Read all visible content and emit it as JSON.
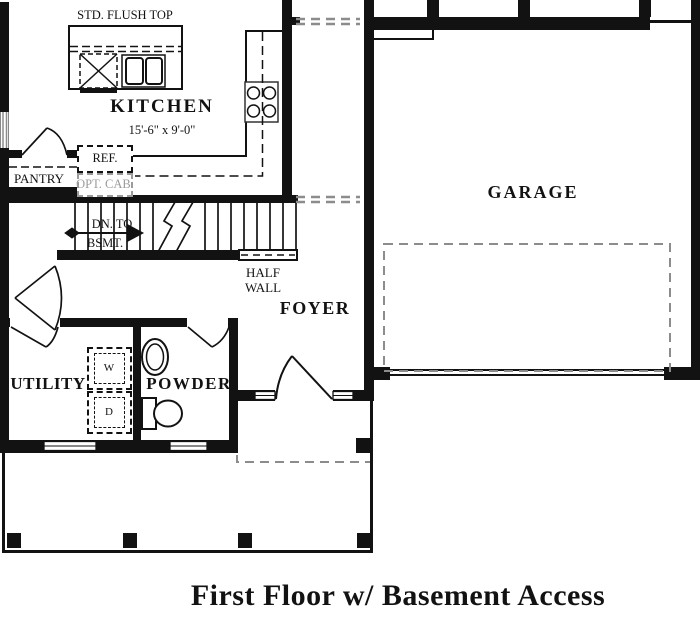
{
  "title": "First Floor w/ Basement Access",
  "rooms": {
    "kitchen": {
      "name": "KITCHEN",
      "dimensions": "15'-6\" x 9'-0\""
    },
    "pantry": {
      "name": "PANTRY"
    },
    "foyer": {
      "name": "FOYER"
    },
    "garage": {
      "name": "GARAGE"
    },
    "utility": {
      "name": "UTILITY"
    },
    "powder": {
      "name": "POWDER"
    }
  },
  "annotations": {
    "island": "STD. FLUSH TOP",
    "refrigerator": "REF.",
    "optional_cabinet": "OPT. CAB.",
    "stairs_line1": "DN. TO",
    "stairs_line2": "BSMT.",
    "half_wall_line1": "HALF",
    "half_wall_line2": "WALL",
    "washer": "W",
    "dryer": "D"
  },
  "colors": {
    "line": "#121212",
    "muted_gray": "#8c8c8c",
    "optional_gray": "#9b9b9b"
  }
}
